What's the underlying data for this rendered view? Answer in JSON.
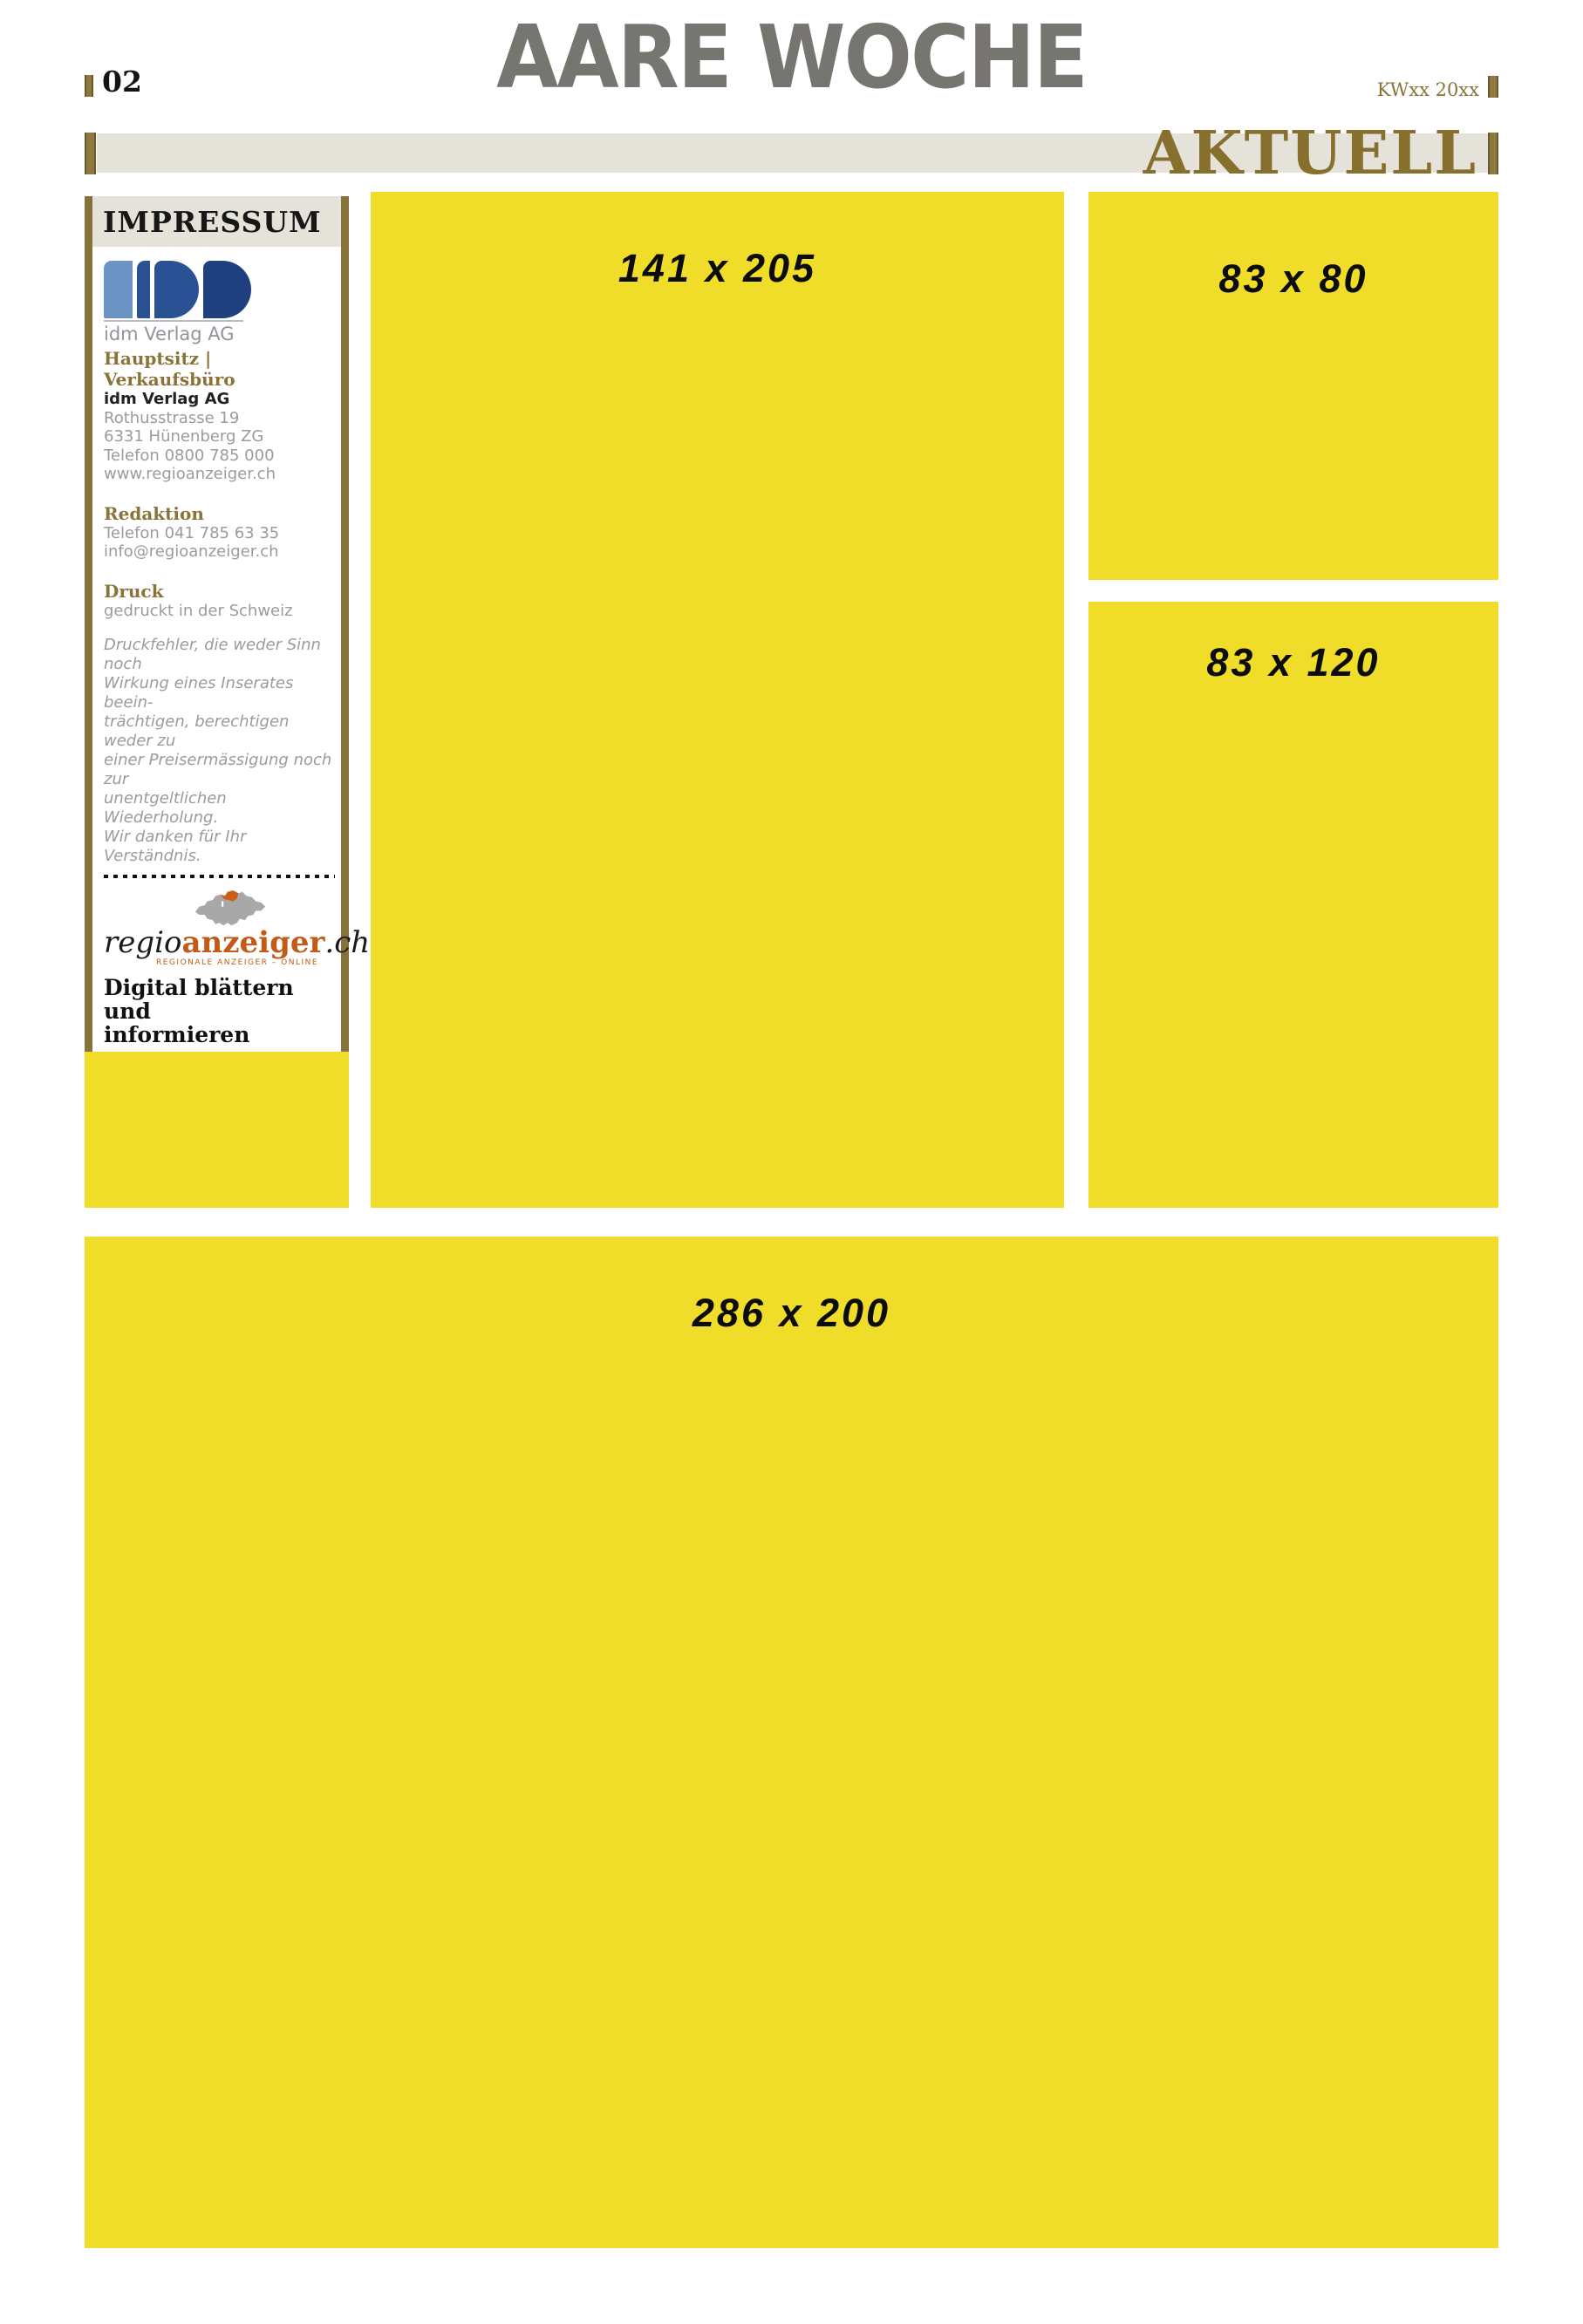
{
  "header": {
    "masthead": "AARE WOCHE",
    "page_number": "02",
    "week_label": "KWxx 20xx",
    "section_label": "AKTUELL"
  },
  "colors": {
    "ad_yellow": "#efdd29",
    "accent_olive": "#87723a",
    "section_text_olive": "#87702e",
    "band_gray": "#e5e2da",
    "masthead_gray": "#76756f",
    "logo_blue_light": "#6b93c4",
    "logo_blue_mid": "#2a5193",
    "logo_blue_dark": "#1f3f7e",
    "logo_orange": "#c35a17",
    "impressum_text_gray": "#9b9b9b"
  },
  "impressum": {
    "title": "IMPRESSUM",
    "logo_caption": "idm Verlag AG",
    "sections": [
      {
        "heading": "Hauptsitz | Verkaufsbüro",
        "company": "idm Verlag AG",
        "lines": [
          "Rothusstrasse 19",
          "6331 Hünenberg ZG",
          "Telefon 0800 785 000",
          "www.regioanzeiger.ch"
        ]
      },
      {
        "heading": "Redaktion",
        "lines": [
          "Telefon 041 785 63 35",
          "info@regioanzeiger.ch"
        ]
      },
      {
        "heading": "Druck",
        "lines": [
          "gedruckt in der Schweiz"
        ]
      }
    ],
    "disclaimer": [
      "Druckfehler, die weder Sinn noch",
      "Wirkung eines Inserates beein-",
      "trächtigen, berechtigen weder zu",
      "einer Preisermässigung noch zur",
      "unentgeltlichen Wiederholung.",
      "Wir danken für Ihr Verständnis."
    ],
    "regioanzeiger": {
      "word_regio": "regio",
      "word_anzeiger": "anzeiger",
      "word_tld": ".ch",
      "tagline": "REGIONALE ANZEIGER – ONLINE"
    },
    "promo_lines": [
      "Digital blättern und",
      "informieren"
    ]
  },
  "ad_slots": [
    {
      "label": "141 x 205"
    },
    {
      "label": "83 x 80"
    },
    {
      "label": "83 x 120"
    },
    {
      "label": "54 x 60"
    },
    {
      "label": "286 x 200"
    }
  ]
}
